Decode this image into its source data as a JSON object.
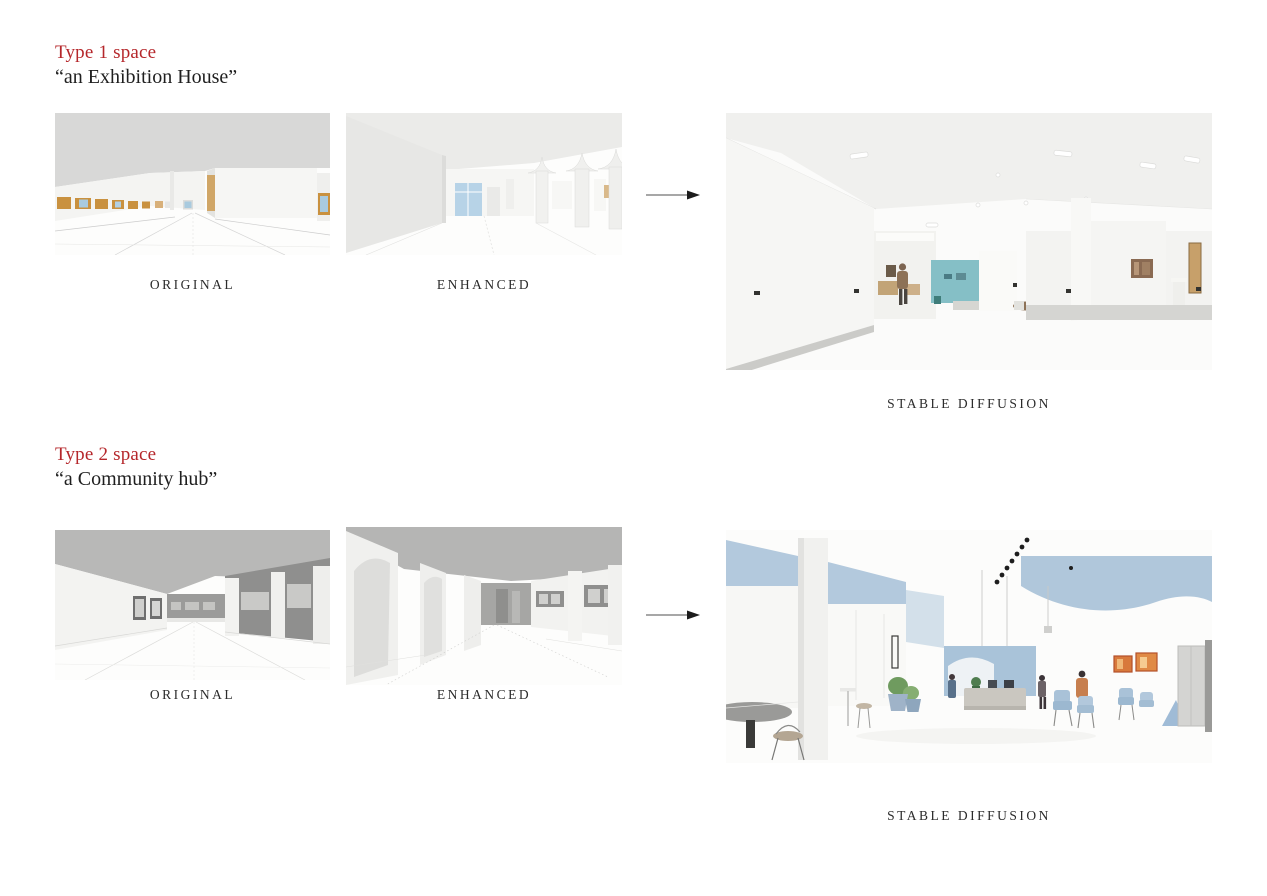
{
  "slide": {
    "background": "#ffffff"
  },
  "colors": {
    "accent_red": "#b5272b",
    "text_dark": "#1f1f1f",
    "label_color": "#2b2b2b",
    "teal_accent_wall": "#85bfc6",
    "blue_accent_band": "#aec6dc",
    "wood_frame": "#c9913f",
    "window_glass": "#a9cade",
    "arrow_line": "#8a8a8a",
    "arrow_head": "#1c1c1c"
  },
  "sections": [
    {
      "title": "Type 1 space",
      "subtitle": "“an Exhibition House”",
      "original_label": "ORIGINAL",
      "enhanced_label": "ENHANCED",
      "result_label": "STABLE DIFFUSION"
    },
    {
      "title": "Type 2 space",
      "subtitle": "“a Community hub”",
      "original_label": "ORIGINAL",
      "enhanced_label": "ENHANCED",
      "result_label": "STABLE DIFFUSION"
    }
  ]
}
